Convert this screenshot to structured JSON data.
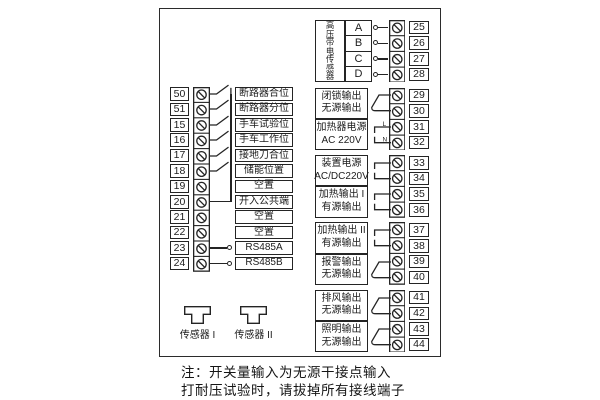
{
  "colors": {
    "ink": "#242424",
    "background": "#ffffff"
  },
  "diagram": {
    "left_inputs": {
      "rows": [
        {
          "terminal": "50",
          "label": "断路器合位",
          "wiring": "switch"
        },
        {
          "terminal": "51",
          "label": "断路器分位",
          "wiring": "switch"
        },
        {
          "terminal": "15",
          "label": "手车试验位",
          "wiring": "switch"
        },
        {
          "terminal": "16",
          "label": "手车工作位",
          "wiring": "switch"
        },
        {
          "terminal": "17",
          "label": "接地刀合位",
          "wiring": "switch"
        },
        {
          "terminal": "18",
          "label": "储能位置",
          "wiring": "switch"
        },
        {
          "terminal": "19",
          "label": "空置",
          "wiring": "none"
        },
        {
          "terminal": "20",
          "label": "开入公共端",
          "wiring": "common"
        },
        {
          "terminal": "21",
          "label": "空置",
          "wiring": "none"
        },
        {
          "terminal": "22",
          "label": "空置",
          "wiring": "none"
        },
        {
          "terminal": "23",
          "label": "RS485A",
          "wiring": "stub"
        },
        {
          "terminal": "24",
          "label": "RS485B",
          "wiring": "stub"
        }
      ]
    },
    "hv_sensor": {
      "title": "高压带电传感器",
      "phases": [
        {
          "letter": "A",
          "terminal": "25"
        },
        {
          "letter": "B",
          "terminal": "26"
        },
        {
          "letter": "C",
          "terminal": "27"
        },
        {
          "letter": "D",
          "terminal": "28"
        }
      ]
    },
    "output_blocks": [
      {
        "line1": "闭锁输出",
        "line2": "无源输出",
        "terminals": [
          "29",
          "30"
        ],
        "wiring": "relay"
      },
      {
        "line1": "加热器电源",
        "line2": "AC 220V",
        "terminals": [
          "31",
          "32"
        ],
        "wiring": "power-ln",
        "wire_labels": [
          "L",
          "N"
        ]
      },
      {
        "line1": "装置电源",
        "line2": "AC/DC220V",
        "terminals": [
          "33",
          "34"
        ],
        "wiring": "power"
      },
      {
        "line1": "加热输出 I",
        "line2": "有源输出",
        "terminals": [
          "35",
          "36"
        ],
        "wiring": "power"
      },
      {
        "line1": "加热输出 II",
        "line2": "有源输出",
        "terminals": [
          "37",
          "38"
        ],
        "wiring": "power"
      },
      {
        "line1": "报警输出",
        "line2": "无源输出",
        "terminals": [
          "39",
          "40"
        ],
        "wiring": "relay"
      },
      {
        "line1": "排风输出",
        "line2": "无源输出",
        "terminals": [
          "41",
          "42"
        ],
        "wiring": "relay"
      },
      {
        "line1": "照明输出",
        "line2": "无源输出",
        "terminals": [
          "43",
          "44"
        ],
        "wiring": "relay"
      }
    ],
    "sensors": [
      {
        "label": "传感器 I"
      },
      {
        "label": "传感器 II"
      }
    ],
    "notes": [
      "注：开关量输入为无源干接点输入",
      "打耐压试验时，请拔掉所有接线端子"
    ]
  }
}
